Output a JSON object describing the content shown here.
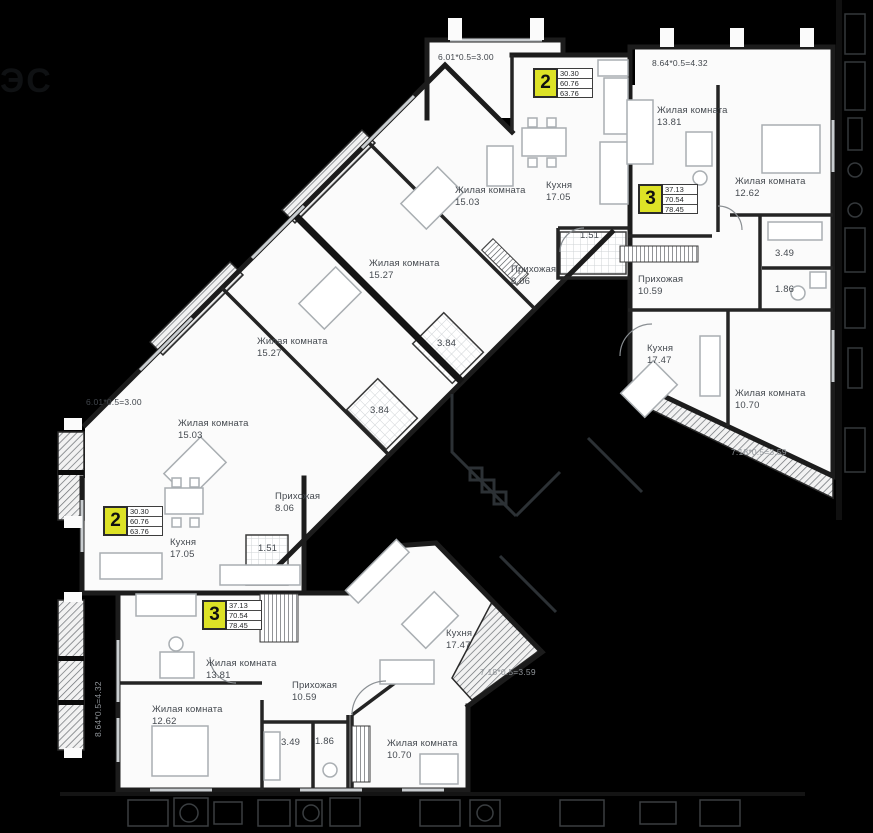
{
  "palette": {
    "background": "#000000",
    "paper": "#fbfbfb",
    "badge_yellow": "#dde226",
    "wall": "#1c1c1c",
    "label_text": "#454a50"
  },
  "logo": {
    "text": "ЭС"
  },
  "badges": {
    "apt2_top": {
      "number": "2",
      "v1": "30.30",
      "v2": "60.76",
      "v3": "63.76"
    },
    "apt3_top": {
      "number": "3",
      "v1": "37.13",
      "v2": "70.54",
      "v3": "78.45"
    },
    "apt2_left": {
      "number": "2",
      "v1": "30.30",
      "v2": "60.76",
      "v3": "63.76"
    },
    "apt3_bot": {
      "number": "3",
      "v1": "37.13",
      "v2": "70.54",
      "v3": "78.45"
    }
  },
  "rooms": {
    "living_1503_top": {
      "name": "Жилая комната",
      "area": "15.03"
    },
    "kitchen_1705_top": {
      "name": "Кухня",
      "area": "17.05"
    },
    "living_1527_a": {
      "name": "Жилая комната",
      "area": "15.27"
    },
    "living_1527_b": {
      "name": "Жилая комната",
      "area": "15.27"
    },
    "hall_806_top": {
      "name": "Прихожая",
      "area": "8.06"
    },
    "bath_151_top": {
      "area": "1.51"
    },
    "bath_384_a": {
      "area": "3.84"
    },
    "bath_384_b": {
      "area": "3.84"
    },
    "living_1381_top": {
      "name": "Жилая комната",
      "area": "13.81"
    },
    "living_1262_top": {
      "name": "Жилая комната",
      "area": "12.62"
    },
    "hall_1059_top": {
      "name": "Прихожая",
      "area": "10.59"
    },
    "bath_349_top": {
      "area": "3.49"
    },
    "wc_186_top": {
      "area": "1.86"
    },
    "kitchen_1747_top": {
      "name": "Кухня",
      "area": "17.47"
    },
    "living_1070_top": {
      "name": "Жилая комната",
      "area": "10.70"
    },
    "living_1503_left": {
      "name": "Жилая комната",
      "area": "15.03"
    },
    "kitchen_1705_left": {
      "name": "Кухня",
      "area": "17.05"
    },
    "hall_806_left": {
      "name": "Прихожая",
      "area": "8.06"
    },
    "bath_151_left": {
      "area": "1.51"
    },
    "living_1381_bot": {
      "name": "Жилая комната",
      "area": "13.81"
    },
    "hall_1059_bot": {
      "name": "Прихожая",
      "area": "10.59"
    },
    "living_1262_bot": {
      "name": "Жилая комната",
      "area": "12.62"
    },
    "kitchen_1747_bot": {
      "name": "Кухня",
      "area": "17.47"
    },
    "living_1070_bot": {
      "name": "Жилая комната",
      "area": "10.70"
    },
    "bath_349_bot": {
      "area": "3.49"
    },
    "wc_186_bot": {
      "area": "1.86"
    }
  },
  "dims": {
    "dim_601_top": {
      "text": "6.01*0.5=3.00"
    },
    "dim_864_top": {
      "text": "8.64*0.5=4.32"
    },
    "dim_718_top": {
      "text": "7.18*0.5=3.59"
    },
    "dim_601_left": {
      "text": "6.01*0.5=3.00"
    },
    "dim_864_left": {
      "text": "8.64*0.5=4.32"
    },
    "dim_718_bot": {
      "text": "7.18*0.5=3.59"
    }
  }
}
